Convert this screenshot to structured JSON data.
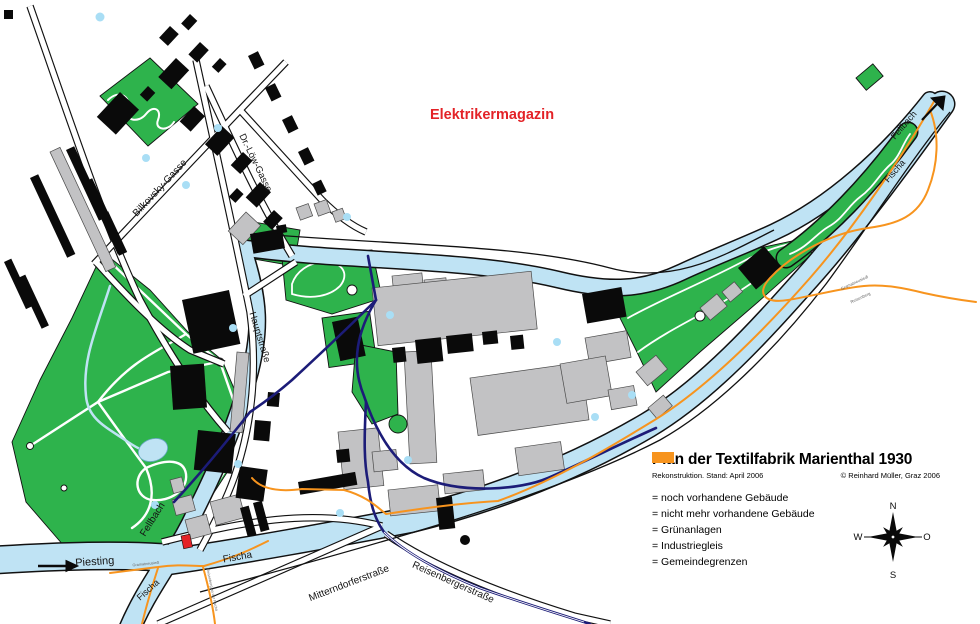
{
  "map": {
    "region_labels": {
      "elektrikermagazin": "Elektrikermagazin"
    },
    "street_labels": {
      "bilkovsky": "Bilkovsky-Gasse",
      "dr_loew": "Dr.-Löw-Gasse",
      "hauptstrasse": "Hauptstraße",
      "mitterndorferstrasse": "Mitterndorferstraße",
      "reisenbergerstrasse": "Reisenbergerstraße"
    },
    "river_labels": {
      "piesting": "Piesting",
      "fellbach_west": "Fellbach",
      "fischa_east": "Fischa",
      "fischa_fork": "Fischa",
      "fellbach_northeast": "Fellbach",
      "fischa_northeast": "Fischa"
    },
    "boundary_labels": {
      "gramatneusiedl_ne": "Gramatneusiedl",
      "reisenberg_ne": "Reisenberg",
      "gramatneusiedl_sw": "Gramatneusiedl",
      "reisenberg_sw": "Reisenberg an der Fischa"
    }
  },
  "legend": {
    "title": "Plan der Textilfabrik Marienthal 1930",
    "subtitle_left": "Rekonstruktion. Stand: April 2006",
    "subtitle_right": "© Reinhard Müller, Graz 2006",
    "items": [
      {
        "label": "= noch vorhandene Gebäude",
        "color": "#000000"
      },
      {
        "label": "= nicht mehr vorhandene Gebäude",
        "color": "#c2c2c4"
      },
      {
        "label": "= Grünanlagen",
        "color": "#2eb34c"
      },
      {
        "label": "= Industriegleis",
        "color": "#1c1c78"
      },
      {
        "label": "= Gemeindegrenzen",
        "color": "#f7941e"
      }
    ]
  },
  "compass": {
    "north": "N",
    "south": "S",
    "west": "W",
    "east": "O"
  },
  "colors": {
    "water": "#bfe3f4",
    "water_dot": "#a9def5",
    "green": "#2eb34c",
    "building_existing": "#000000",
    "building_gone": "#c2c2c4",
    "industrial_rail": "#1c1c78",
    "municipal_boundary": "#f7941e",
    "highlight_red": "#e32227"
  }
}
